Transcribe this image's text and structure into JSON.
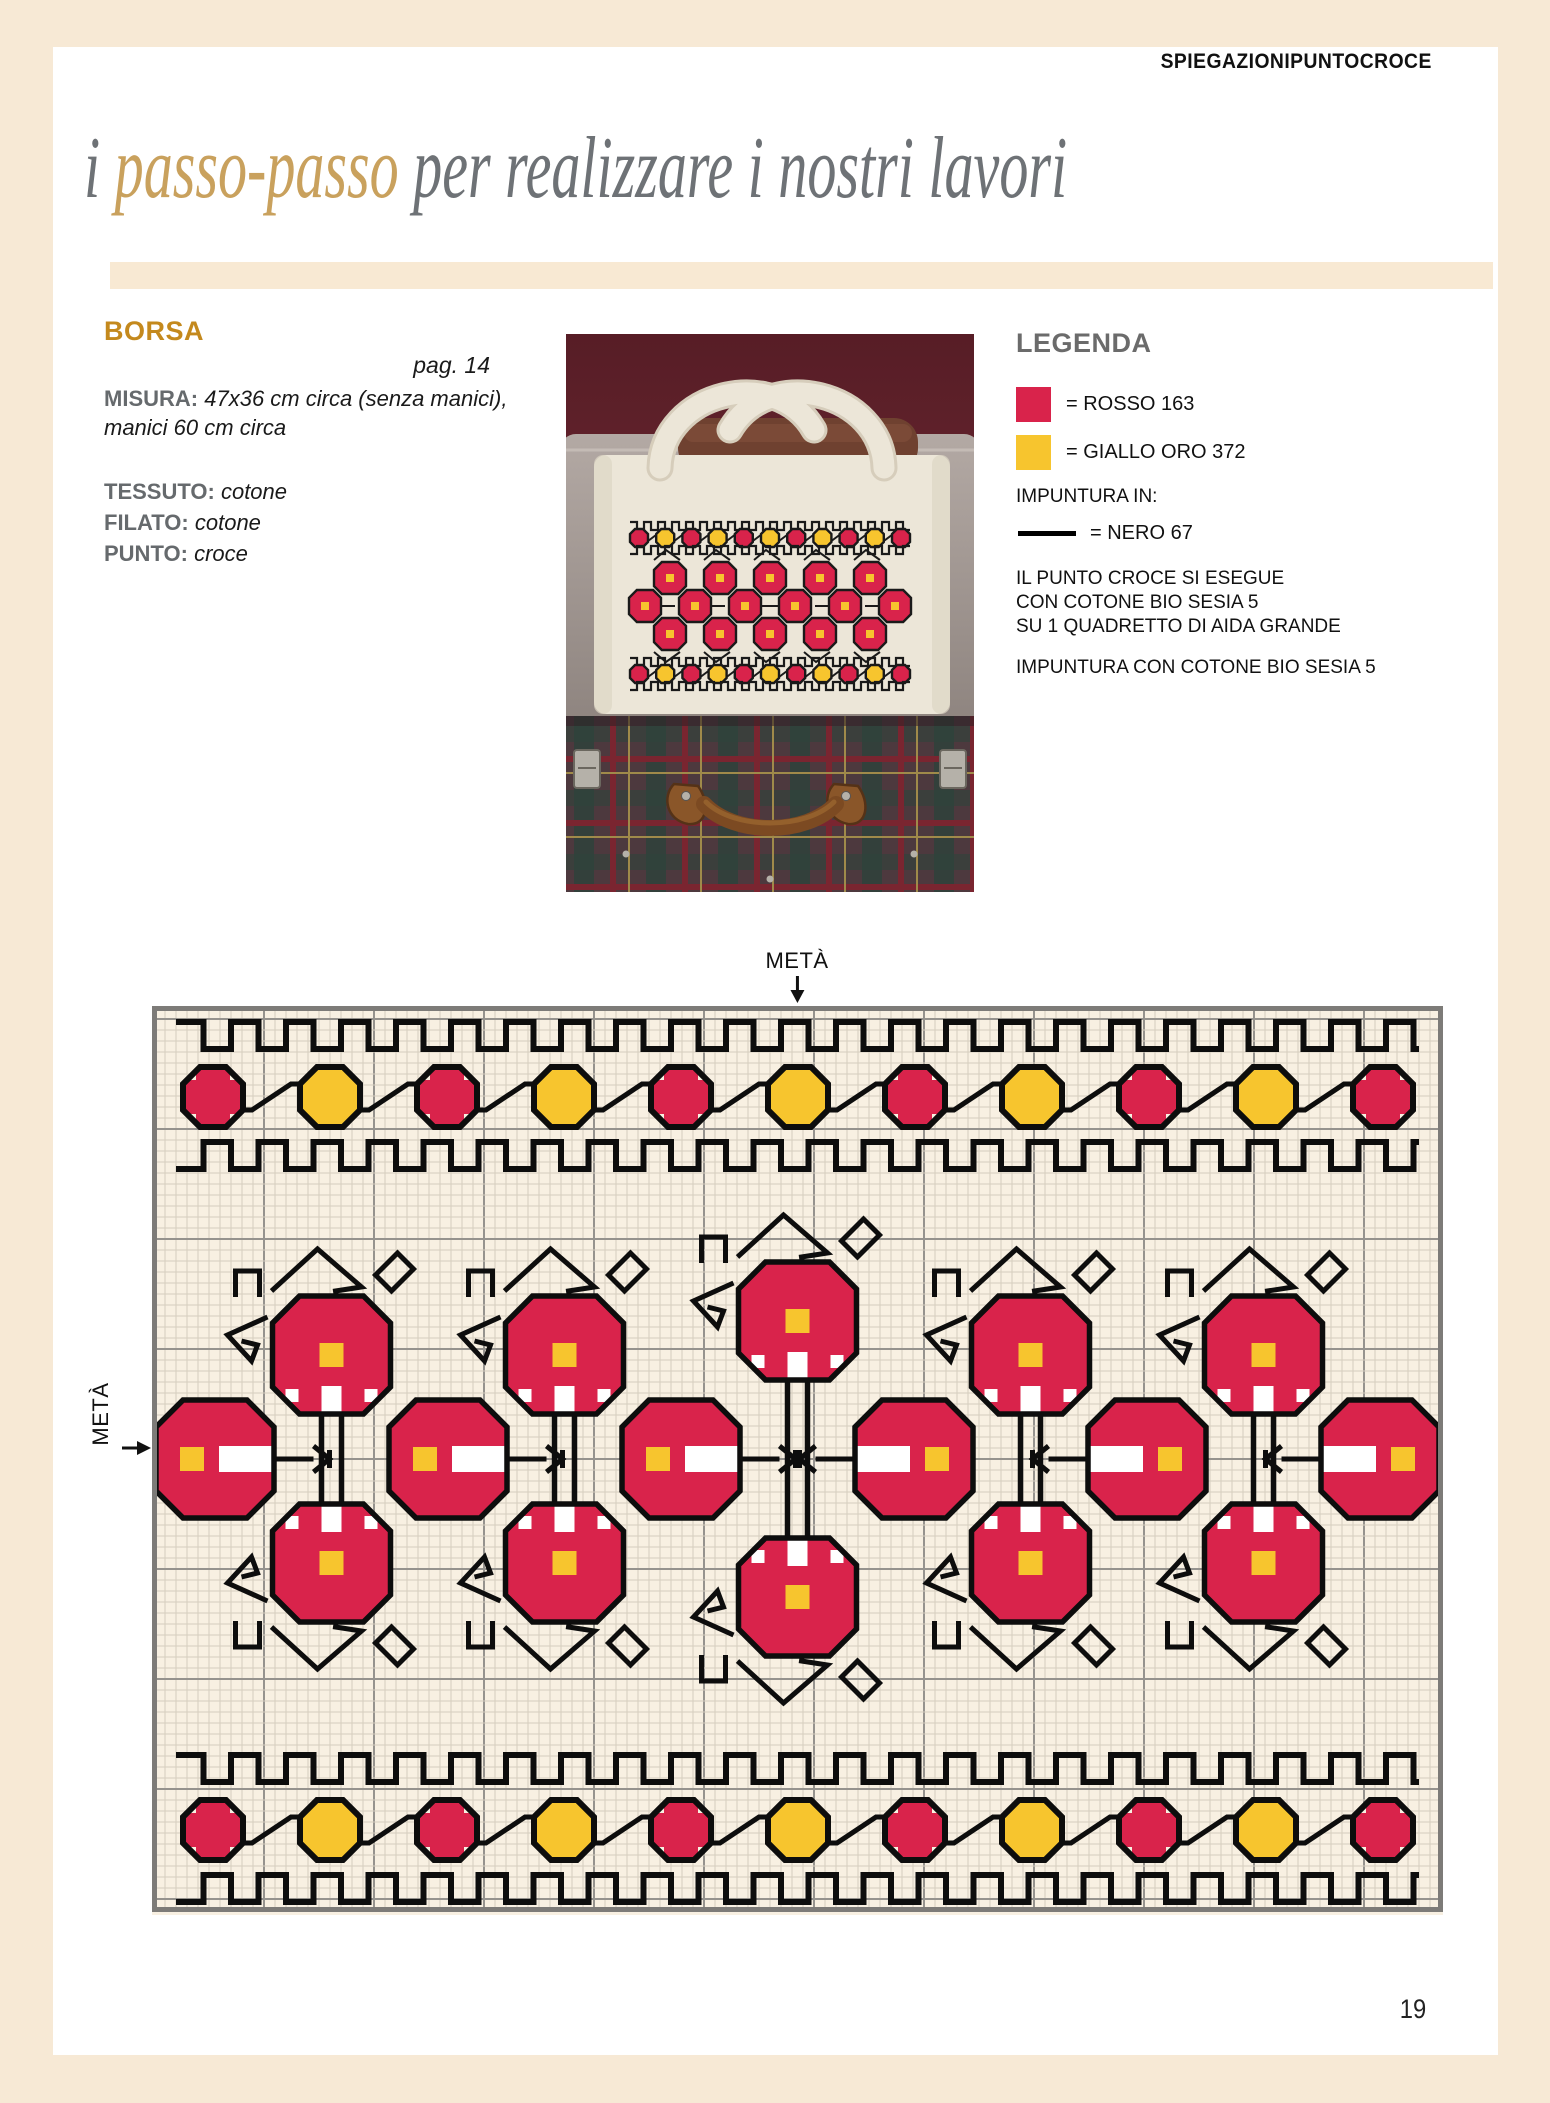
{
  "page": {
    "number": "19",
    "frame_color": "#f7e9d5"
  },
  "header": {
    "kicker_bold": "SPIEGAZIONI",
    "kicker_light": "PUNTOCROCE",
    "title_prefix": "i ",
    "title_accent": "passo-passo",
    "title_rest": " per realizzare i nostri lavori",
    "title_color": "#6e7276",
    "accent_color": "#c9a15d"
  },
  "project": {
    "name": "BORSA",
    "name_color": "#c4891d",
    "page_ref": "pag. 14",
    "misura_label": "MISURA:",
    "misura_value": "47x36 cm circa (senza manici), manici 60 cm circa",
    "specs": [
      {
        "label": "TESSUTO:",
        "value": "cotone"
      },
      {
        "label": "FILATO:",
        "value": "cotone"
      },
      {
        "label": "PUNTO:",
        "value": "croce"
      }
    ]
  },
  "legend": {
    "title": "LEGENDA",
    "colors": [
      {
        "swatch": "#d9234b",
        "label": "= ROSSO 163"
      },
      {
        "swatch": "#f7c52e",
        "label": "= GIALLO ORO 372"
      }
    ],
    "stitch_heading": "IMPUNTURA IN:",
    "line_label": "= NERO 67",
    "line_color": "#000000",
    "notes": [
      "IL PUNTO CROCE SI ESEGUE",
      "CON COTONE BIO SESIA 5",
      "SU 1 QUADRETTO DI AIDA GRANDE"
    ],
    "note2": "IMPUNTURA CON COTONE BIO SESIA 5"
  },
  "chart": {
    "meta_label": "METÀ",
    "bg": "#f8f0e2",
    "grid_minor": "#d5cdbe",
    "grid_major": "#96938e",
    "frame": "#7d7b78",
    "black": "#0d0d0d",
    "red": "#d9234b",
    "yellow": "#f7c52e",
    "white": "#ffffff",
    "border_octagon_colors": [
      "red",
      "yellow",
      "red",
      "yellow",
      "red",
      "yellow",
      "red",
      "yellow",
      "red",
      "yellow",
      "red"
    ],
    "main_top_row_count": 5,
    "main_middle_row_count": 6,
    "main_bottom_row_count": 5
  },
  "photo": {
    "bg_dark": "#571d26",
    "bg_mid": "#6b2731",
    "case_gray_light": "#b3a9a4",
    "case_gray_dark": "#8e847f",
    "leather_bar": "#6f4130",
    "bag": "#ece6d8",
    "bag_shadow": "#d6cdbb",
    "tartan_base": "#4d393e",
    "tartan_green": "#2f423b",
    "tartan_red": "#7a2530",
    "tartan_gold": "#a08a4a",
    "handle_brown": "#7c4a22",
    "handle_tab": "#8a5629",
    "metal": "#b5b1a9",
    "red": "#d9234b",
    "yellow": "#f7c52e",
    "black": "#1a1a1a"
  }
}
